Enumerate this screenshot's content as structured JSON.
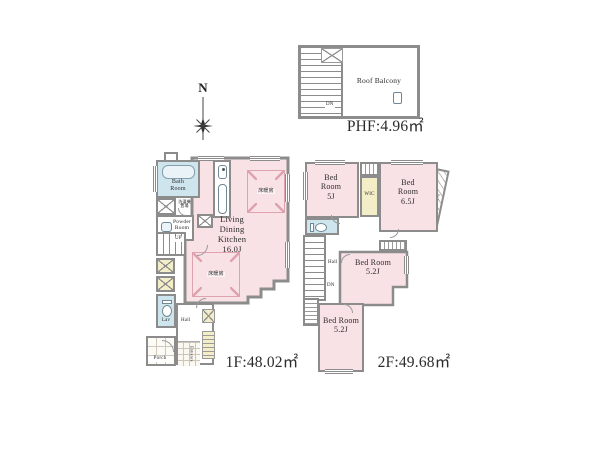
{
  "colors": {
    "wall": "#8c8c8c",
    "room_pink": "#f9e2e6",
    "wet_blue": "#cfe5ee",
    "closet_yellow": "#f3edc8",
    "heat_accent": "#dfa3ad",
    "text": "#2b2b2b"
  },
  "compass": {
    "north_label": "N"
  },
  "phf": {
    "area_label": "PHF:4.96㎡",
    "balcony_label": "Roof Balcony",
    "stairs_label": "DN"
  },
  "f1": {
    "area_label": "1F:48.02㎡",
    "bath_label": "Bath Room",
    "powder_label": "Powder Room",
    "washer_label": "洗濯機置場",
    "ldk_label": "Living Dining Kitchen",
    "ldk_size": "16.0J",
    "floor_heating_label": "床暖房",
    "stairs_label": "UP",
    "lav_label": "Lav",
    "hall_label": "Hall",
    "entrance_label": "Entrance",
    "porch_label": "Porch"
  },
  "f2": {
    "area_label": "2F:49.68㎡",
    "bedrooms": [
      {
        "name": "Bed Room",
        "size": "5J"
      },
      {
        "name": "Bed Room",
        "size": "6.5J"
      },
      {
        "name": "Bed Room",
        "size": "5.2J"
      },
      {
        "name": "Bed Room",
        "size": "5.2J"
      }
    ],
    "wic_label": "WIC",
    "hall_label": "Hall",
    "stairs_label": "DN",
    "balcony_label": "Balcony"
  }
}
